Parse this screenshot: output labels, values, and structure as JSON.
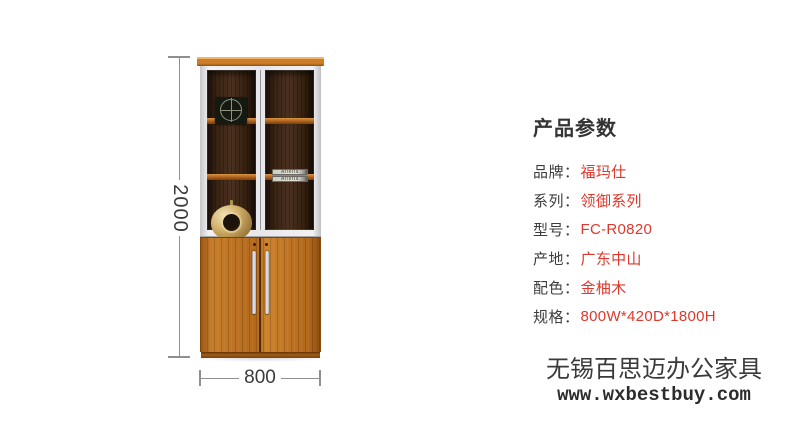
{
  "product_image": {
    "dimensions": {
      "height_label": "2000",
      "width_label": "800"
    },
    "decor": {
      "book1_title": "Arietta",
      "book2_title": "Arietta"
    },
    "colors": {
      "wood_teak": "#b4691c",
      "shelf_orange": "#ad5f1d",
      "frame_white": "#e7e7e9",
      "interior_dark": "#3a2515"
    }
  },
  "specs": {
    "title": "产品参数",
    "label_color": "#3d3d3d",
    "value_color": "#dd382b",
    "rows": [
      {
        "label": "品牌：",
        "value": "福玛仕"
      },
      {
        "label": "系列：",
        "value": "领御系列"
      },
      {
        "label": "型号：",
        "value": "FC-R0820"
      },
      {
        "label": "产地：",
        "value": "广东中山"
      },
      {
        "label": "配色：",
        "value": "金柚木"
      },
      {
        "label": "规格：",
        "value": "800W*420D*1800H"
      }
    ]
  },
  "watermark": {
    "line1": "无锡百思迈办公家具",
    "line2": "www.wxbestbuy.com"
  }
}
